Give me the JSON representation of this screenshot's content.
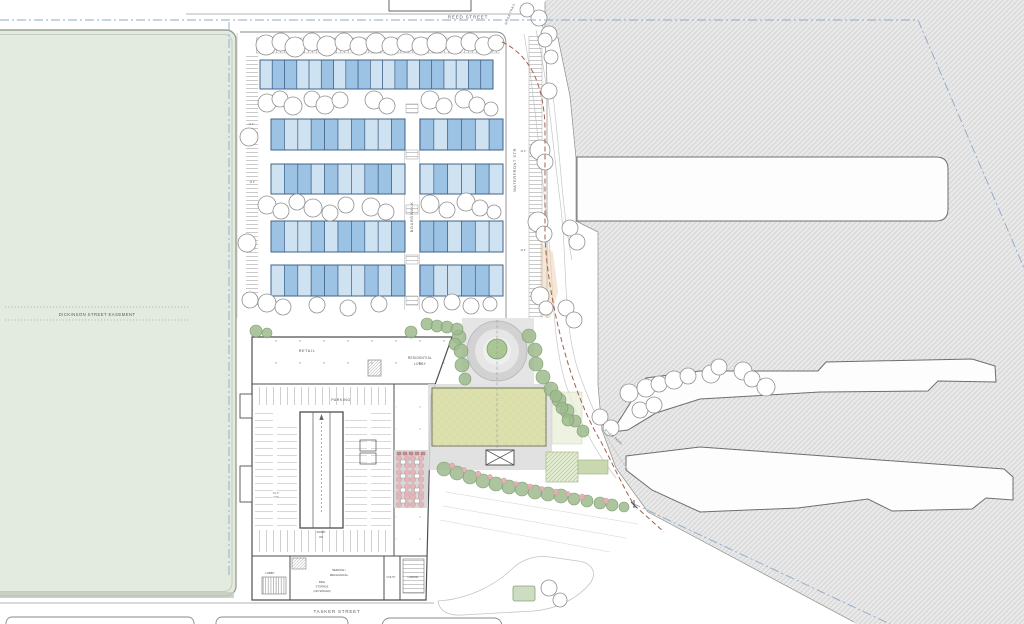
{
  "plan": {
    "title": "waterfront-development-site-plan",
    "streets": {
      "reed": "REED STREET",
      "tasker": "TASKER STREET",
      "dickinson_easement": "DICKINSON STREET EASEMENT",
      "waterfront": "WATERFRONT STR",
      "boardwalk": "BOARDWALK",
      "river_trail_north": "RIVER TRAIL",
      "river_trail_south": "RIVER TRAIL"
    },
    "building": {
      "retail": "RETAIL",
      "residential_lobby": [
        "RESIDENTIAL",
        "LOBBY"
      ],
      "parking": "PARKING",
      "ramp": [
        "RAMP",
        "UP"
      ],
      "dim_typ": [
        "24'-0\"",
        "TYP."
      ],
      "lobby": "LOBBY",
      "service_mechanical": [
        "SERVICE /",
        "MECHANICAL"
      ],
      "bike_storage": [
        "BIKE",
        "STORAGE",
        "(120 SPACES)"
      ],
      "utility": "UTILITY",
      "loading": "LOADING"
    },
    "parking_counts": {
      "left_north": "14 P",
      "left_south": "16 P",
      "waterfront_north": "10 P",
      "waterfront_south": "10 P"
    },
    "townhouses": {
      "stroke": "#41638a",
      "fill_light": "#cfe2f1",
      "fill_medium": "#9dc3e4",
      "rows": [
        {
          "y": 60,
          "h": 29,
          "groups": [
            {
              "x": 260,
              "w": 233,
              "shades": "LMMLLMLMMLLMLMMLLMM"
            }
          ]
        },
        {
          "y": 119,
          "h": 31,
          "groups": [
            {
              "x": 271,
              "w": 134,
              "shades": "MLLMMLMLLM"
            },
            {
              "x": 420,
              "w": 83,
              "shades": "MLMMLM"
            }
          ]
        },
        {
          "y": 164,
          "h": 30,
          "groups": [
            {
              "x": 271,
              "w": 134,
              "shades": "LMMLMLLMML"
            },
            {
              "x": 420,
              "w": 83,
              "shades": "LMLLML"
            }
          ]
        },
        {
          "y": 221,
          "h": 31,
          "groups": [
            {
              "x": 271,
              "w": 134,
              "shades": "MLLMLMMLLM"
            },
            {
              "x": 420,
              "w": 83,
              "shades": "MMLMLL"
            }
          ]
        },
        {
          "y": 265,
          "h": 31,
          "groups": [
            {
              "x": 271,
              "w": 134,
              "shades": "LMLMMLLMLM"
            },
            {
              "x": 420,
              "w": 83,
              "shades": "MLLMML"
            }
          ]
        }
      ]
    },
    "colors": {
      "easement_green": "#e3eadf",
      "water_hatch_base": "#e9e9e9",
      "water_hatch_line": "#d4d4d4",
      "lawn_green": "#dbe0ac",
      "tree_green": "#9dbb8e",
      "blossom_pink": "#dfaeb0",
      "property_line_blue": "#8fa9c9",
      "bulkhead_line_red": "#a2604e"
    }
  }
}
